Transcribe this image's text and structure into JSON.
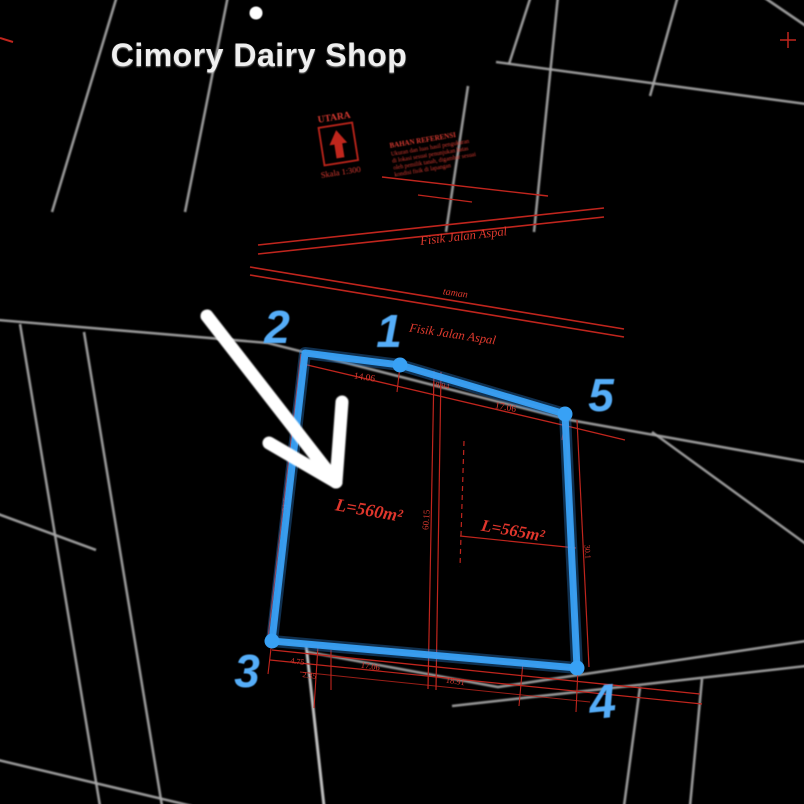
{
  "poi": {
    "name": "Cimory Dairy Shop"
  },
  "legend": {
    "north_label": "UTARA",
    "scale_label": "Skala 1:300",
    "notes_title": "BAHAN REFERENSI",
    "notes_lines": [
      "Ukuran dan luas hasil pengukuran",
      "di lokasi sesuai penunjukan batas",
      "oleh pemilik tanah, digambar sesuai",
      "kondisi fisik di lapangan"
    ]
  },
  "roads": {
    "top_road_label": "Fisik Jalan Aspal",
    "strip_label": "taman",
    "front_road_label": "Fisik Jalan Aspal"
  },
  "parcel": {
    "area_left": "L=560m²",
    "area_right": "L=565m²",
    "vertex_labels": {
      "v1": "1",
      "v2": "2",
      "v3": "3",
      "v4": "4",
      "v5": "5"
    },
    "dimensions": {
      "top_1": "14.06",
      "top_2": "8.94",
      "top_3": "17.06",
      "bottom_1": "4.75",
      "bottom_2": "2.35",
      "bottom_3": "17.06",
      "bottom_4": "18.91",
      "center": "60.15",
      "left": "31.5",
      "right": "30.1"
    }
  },
  "colors": {
    "background": "#000000",
    "road_gray": "#a8a8a8",
    "survey_red": "#c0251d",
    "parcel_blue": "#38a1f5",
    "number_blue": "#55adf8",
    "annotation_white": "#ffffff"
  }
}
